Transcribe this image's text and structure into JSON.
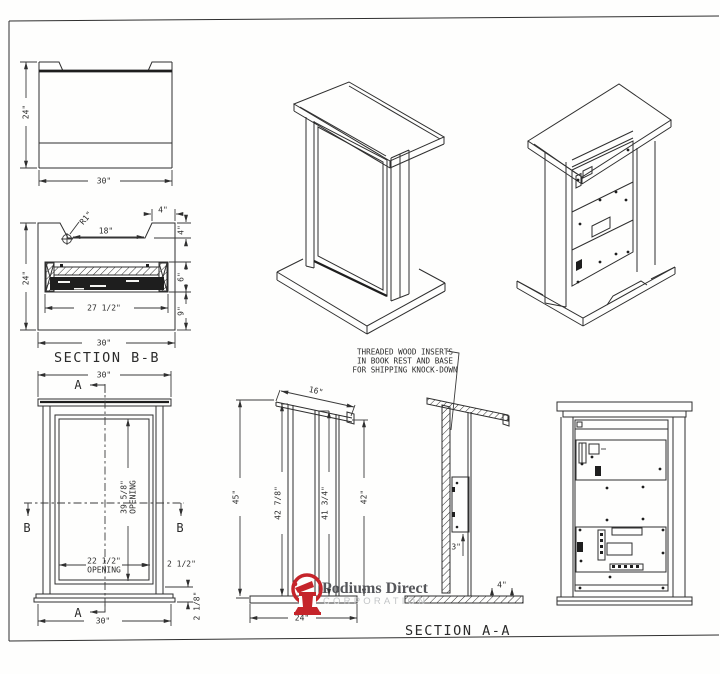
{
  "sheet": {
    "background": "#fefefd",
    "line_color": "#2f2f2f",
    "accent_red": "#c5242a"
  },
  "plan_view": {
    "height_dim": "24\"",
    "width_dim": "30\""
  },
  "section_bb": {
    "title": "SECTION B-B",
    "radius_dim": "R1\"",
    "notch_width_dim": "18\"",
    "ledge_dim": "4\"",
    "notch_depth_dim": "4\"",
    "height_dim": "24\"",
    "shelf_depth_dim": "6\"",
    "shelf_width_dim": "27 1/2\"",
    "lower_height_dim": "9\"",
    "width_dim": "30\""
  },
  "front_view": {
    "top_width_dim": "30\"",
    "bottom_width_dim": "30\"",
    "opening_height_dim": "39 5/8\"",
    "opening_label": "OPENING",
    "opening_width_dim": "22 1/2\"",
    "stile_dim": "2 1/2\"",
    "base_height_dim": "2 1/8\"",
    "cut_a": "A",
    "cut_b": "B"
  },
  "section_aa": {
    "title": "SECTION A-A",
    "note_line1": "THREADED WOOD INSERTS",
    "note_line2": "IN BOOK REST AND BASE",
    "note_line3": "FOR SHIPPING KNOCK-DOWN",
    "bookrest_dim": "16\"",
    "overall_height_dim": "45\"",
    "front_height_dim": "42 7/8\"",
    "mid_height_dim": "41 3/4\"",
    "rear_height_dim": "42\"",
    "base_width_dim": "24\"",
    "insert_dim": "3\"",
    "base_edge_dim": "4\""
  },
  "logo": {
    "name": "Podiums Direct",
    "subtitle": "CORPORATION"
  }
}
